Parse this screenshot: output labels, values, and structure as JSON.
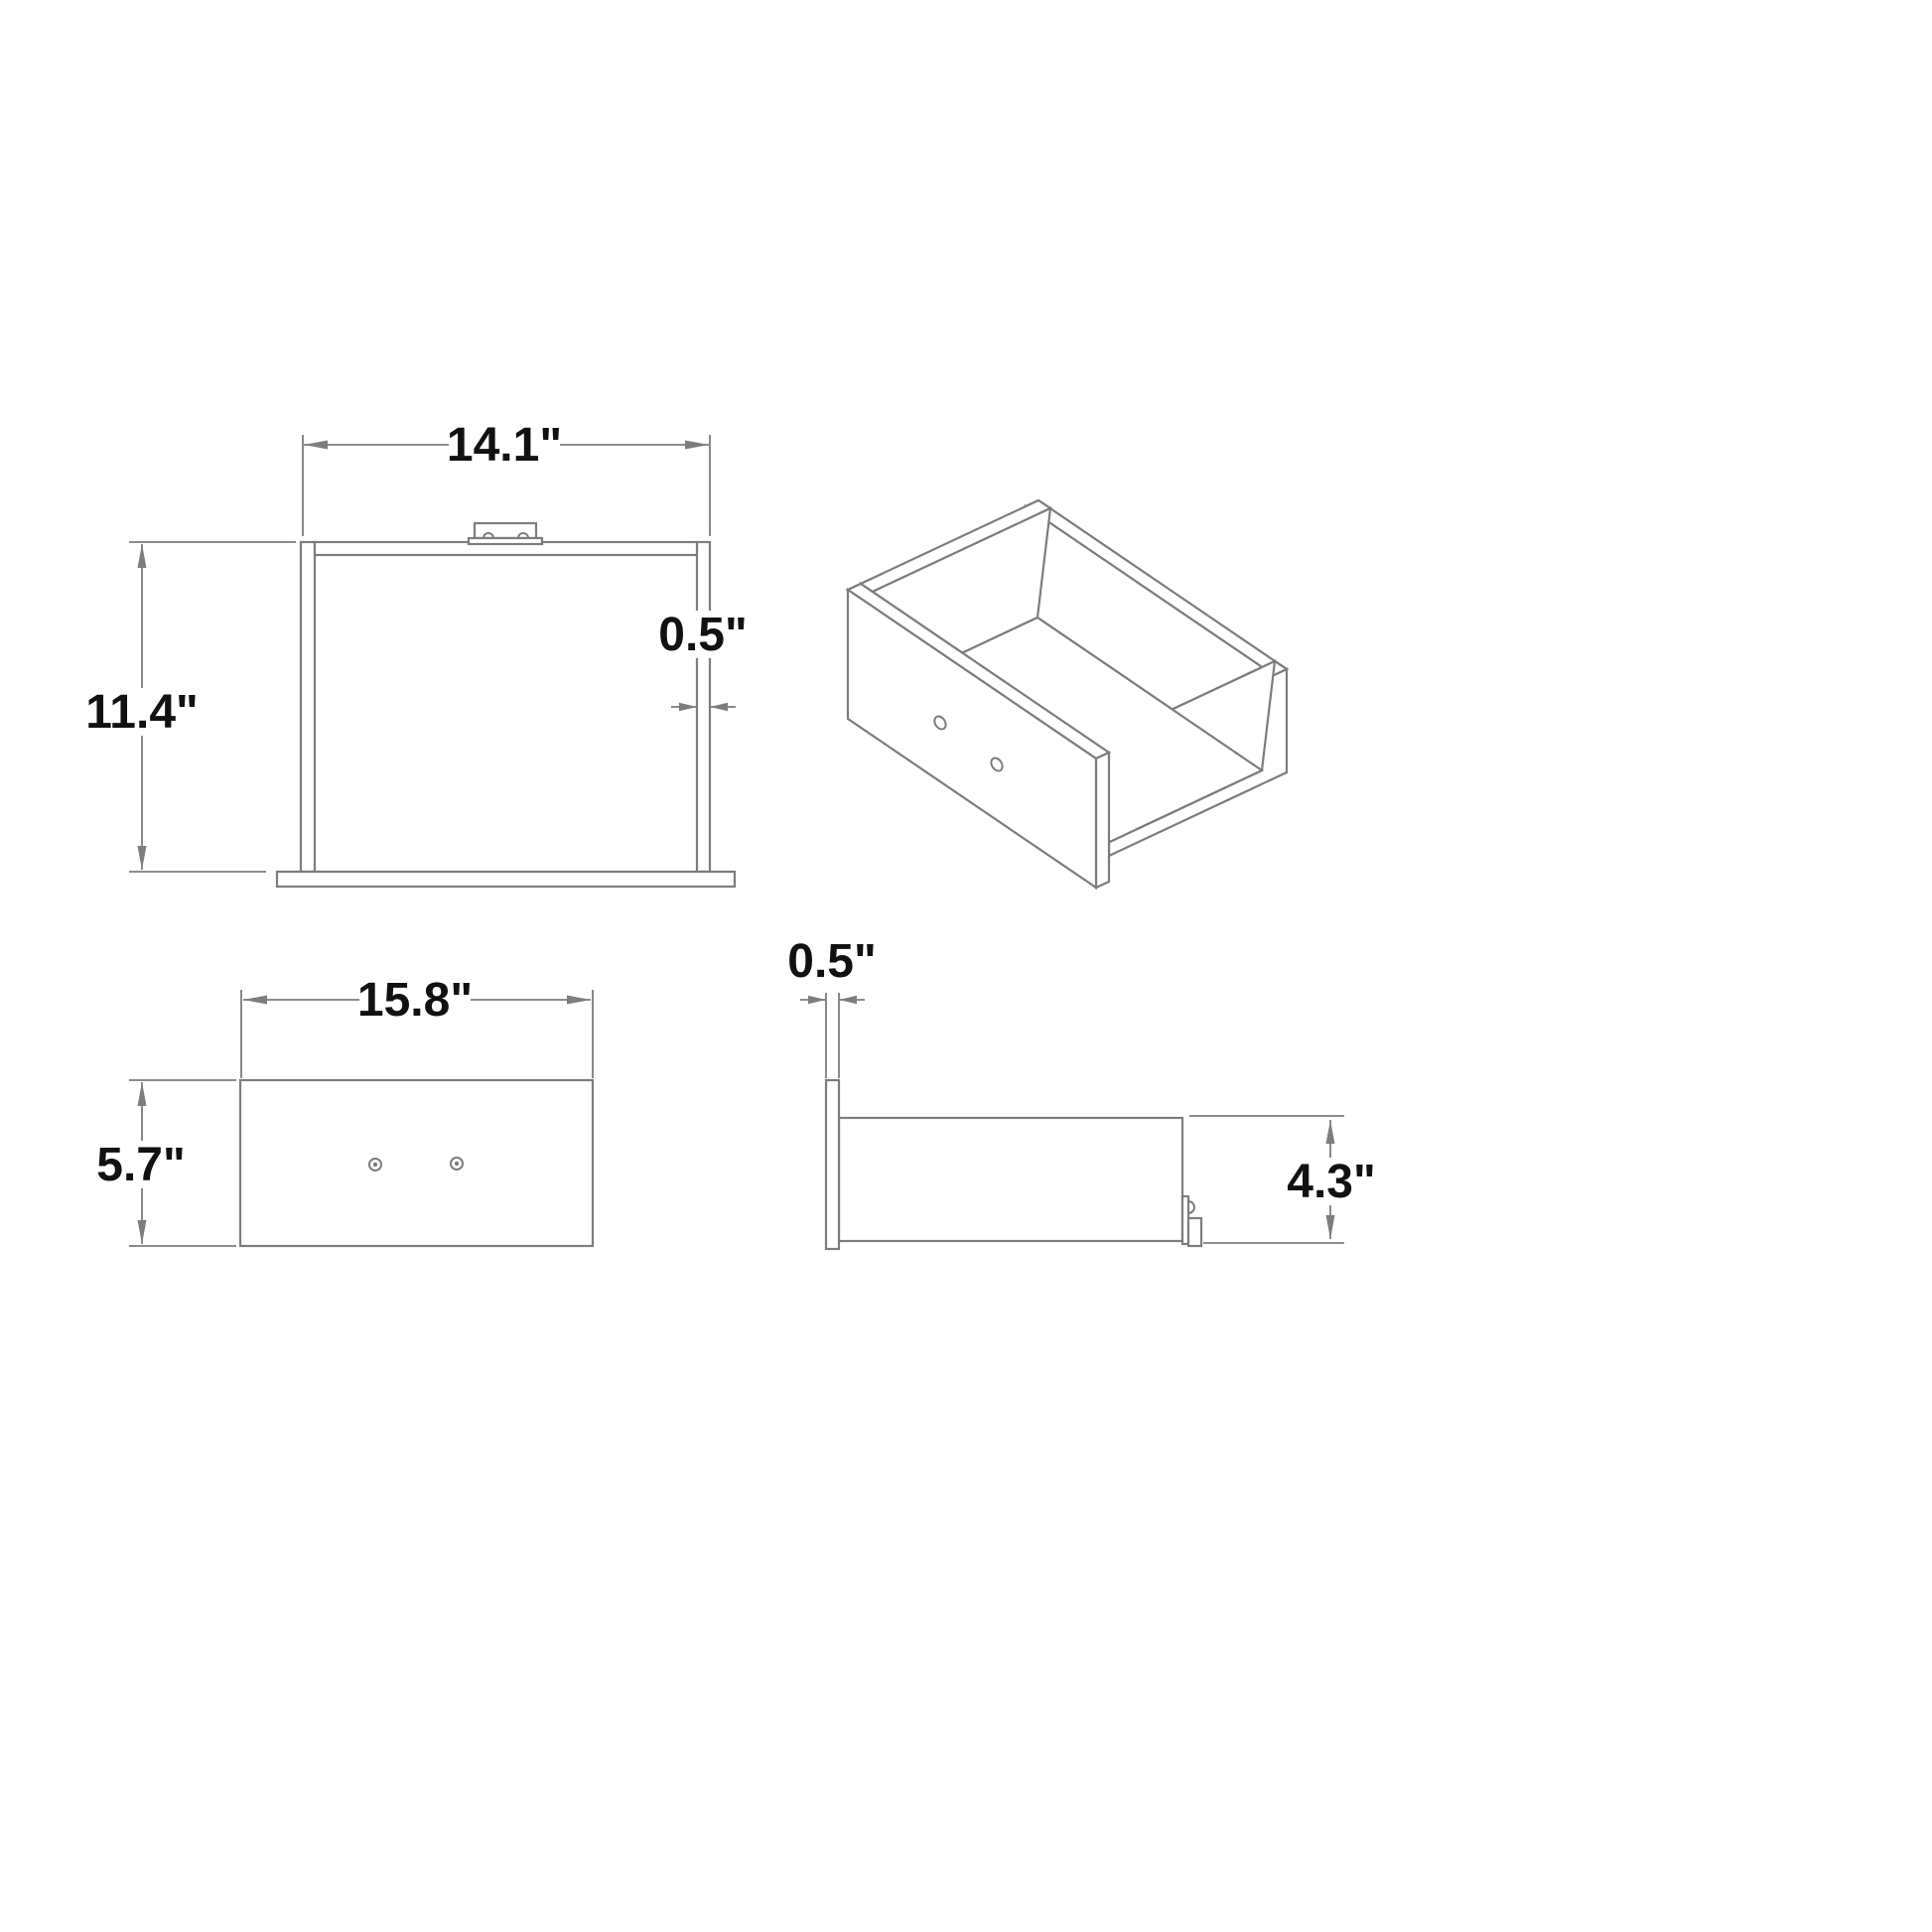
{
  "drawing": {
    "background_color": "#ffffff",
    "line_color": "#7d7d7d",
    "text_color": "#111111",
    "views": {
      "top_view": {
        "dims": {
          "width": "14.1\"",
          "height": "11.4\"",
          "wall_thickness": "0.5\""
        }
      },
      "front_view": {
        "dims": {
          "width": "15.8\"",
          "height": "5.7\""
        }
      },
      "side_view": {
        "dims": {
          "panel_thickness": "0.5\"",
          "height": "4.3\""
        }
      },
      "isometric_view": {}
    }
  }
}
